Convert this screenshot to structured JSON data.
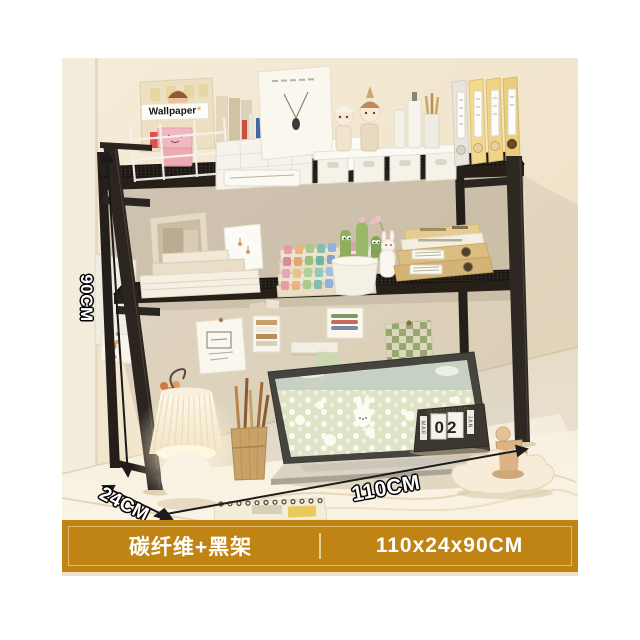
{
  "product_banner": {
    "variant_label": "碳纤维+黑架",
    "size_label": "110x24x90CM",
    "background_color": "#c08414",
    "inner_border_color": "#e2bc6a",
    "text_color": "#ffffff"
  },
  "dimension_labels": {
    "height": "90CM",
    "depth": "24CM",
    "width": "110CM"
  },
  "shelf_items": {
    "magazine_title": "Wallpaper",
    "magazine_title_star": "*"
  },
  "desk_items": {
    "flip_calendar": {
      "month_left": "MAR",
      "day": "02",
      "month_right": "JAN"
    }
  },
  "scene_colors": {
    "wall": "#f2e7d1",
    "desk": "#f7f0e2",
    "shelf_frame": "#2b241f",
    "folder_yellow": "#f3d98e",
    "banner_gold": "#c08414"
  }
}
